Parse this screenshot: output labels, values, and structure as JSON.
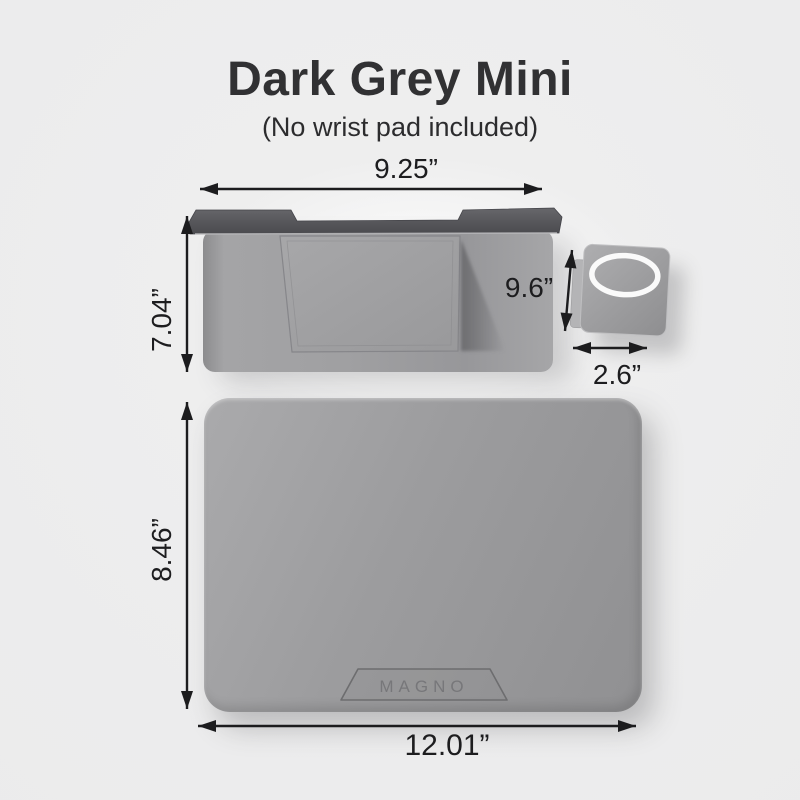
{
  "title": "Dark Grey Mini",
  "subtitle": "(No wrist pad included)",
  "dimensions": {
    "laptop_stand_width": "9.25”",
    "laptop_stand_depth": "7.04”",
    "phone_stand_length": "9.6”",
    "phone_stand_width": "2.6”",
    "desk_pad_depth": "8.46”",
    "desk_pad_width": "12.01”"
  },
  "desk_pad": {
    "logo": "MAGNO"
  },
  "colors": {
    "background": "#ededee",
    "title_text": "#313133",
    "dimension_text": "#1d1d1f",
    "arrow": "#1c1c1e",
    "stand_top_bar": "#555559",
    "stand_body": "#9b9b9d",
    "desk_pad_grey": "#9a9a9c",
    "magsafe_ring": "#fafafa",
    "logo_text": "#78787a"
  }
}
